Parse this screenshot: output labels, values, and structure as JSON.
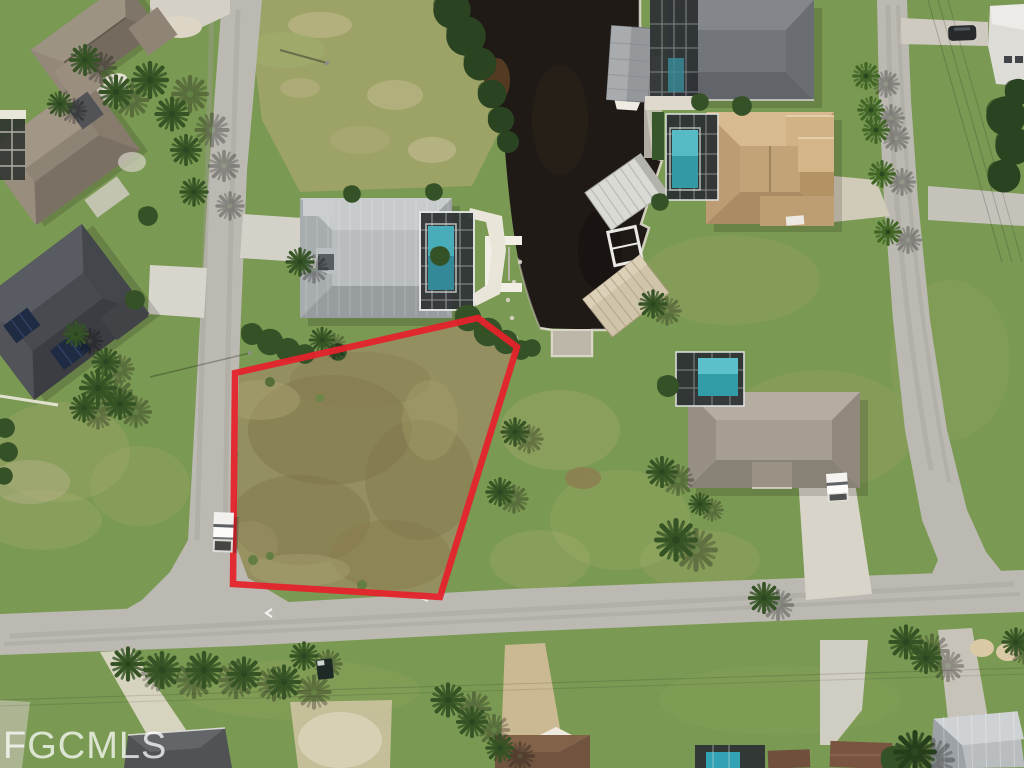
{
  "image": {
    "kind": "aerial-drone-photo",
    "subject": "Vacant canal-front residential lot outlined in red in a Florida-style neighborhood",
    "width_px": 1024,
    "height_px": 768
  },
  "watermark": {
    "text": "FGCMLS"
  },
  "boundary": {
    "points": "235,373 478,318 517,347 440,597 233,584",
    "color": "#e41b26",
    "stroke_width": "6.5"
  },
  "palette": {
    "grass": "#75964e",
    "road": "#b9b8b1",
    "side_street": "#c2c1b9",
    "water": "#171210",
    "pool": "#2a96a6",
    "sand": "#c2b98f",
    "roof_metal": "#b0b5b8",
    "roof_tan": "#c3a379",
    "roof_charcoal": "#43464c"
  },
  "scene": {
    "streets": [
      "left-street",
      "main-street-bottom",
      "right-street",
      "east-side-street"
    ],
    "houses": [
      "top-left-house",
      "west-house",
      "solar-panel-house",
      "metal-roof-house",
      "north-canal-house",
      "tan-tile-house",
      "east-gray-house",
      "bottom-left-house",
      "bottom-tan-drive-house",
      "bottom-pool-house",
      "bottom-metal-house",
      "top-right-house"
    ],
    "vehicles": [
      "white-pickup-on-street",
      "white-truck-in-driveway",
      "dark-suv-top-right",
      "dark-truck-bottom"
    ],
    "water_features": [
      "canal",
      "boat-lift-canopy-north",
      "boat-lift-canopy-mid",
      "boat-lift-canopy-south",
      "white-boat-dock",
      "canal-end-dock"
    ]
  }
}
